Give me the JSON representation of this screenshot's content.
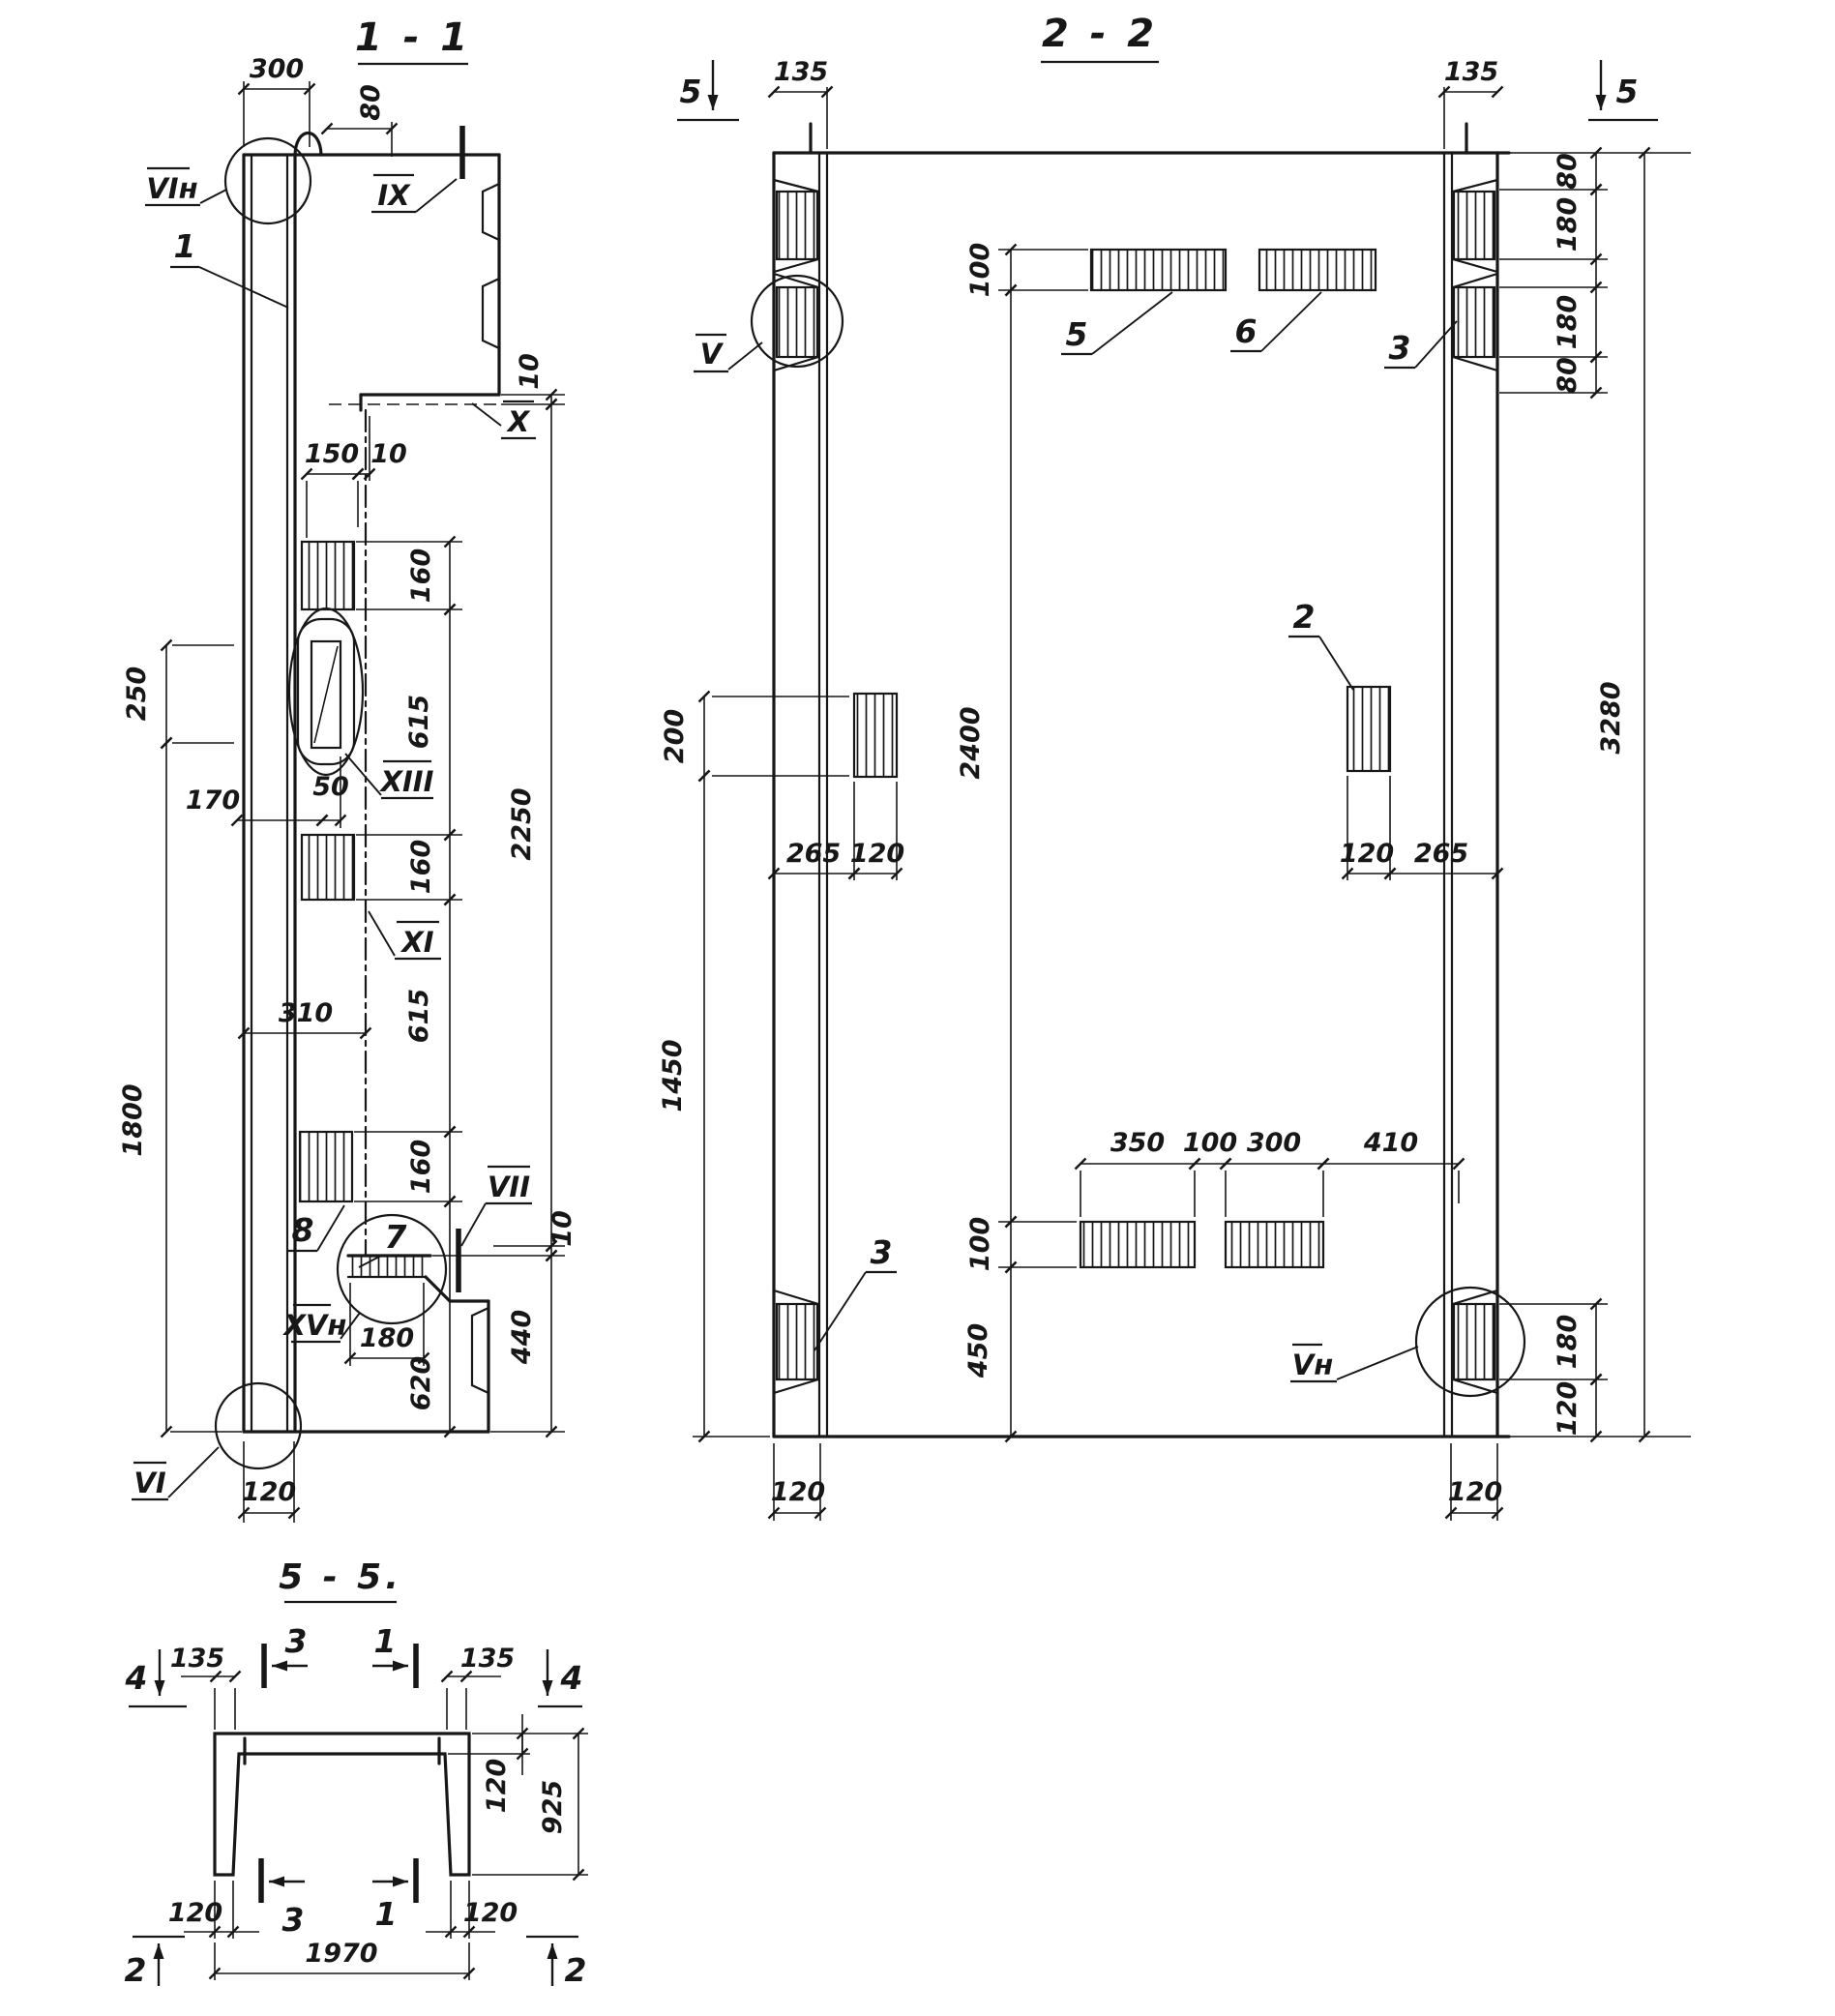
{
  "drawing": {
    "s1": {
      "title": "1 - 1",
      "dims": {
        "d300": "300",
        "d80": "80",
        "d150": "150",
        "d10a": "10",
        "d10b": "10",
        "d10c": "10",
        "d160a": "160",
        "d615a": "615",
        "d160b": "160",
        "d615b": "615",
        "d160c": "160",
        "d250": "250",
        "d170": "170",
        "d50": "50",
        "d310": "310",
        "d1800": "1800",
        "d2250": "2250",
        "d440": "440",
        "d620": "620",
        "d180": "180",
        "d120": "120"
      },
      "marks": {
        "vin": "VIн",
        "ix": "IX",
        "x": "X",
        "xiii": "XIII",
        "xi": "XI",
        "vii": "VII",
        "xvn": "XVн",
        "vi": "VI"
      },
      "callouts": {
        "c1": "1",
        "c7": "7",
        "c8": "8"
      }
    },
    "s2": {
      "title": "2 - 2",
      "cutmark5l": "5",
      "cutmark5r": "5",
      "dims": {
        "d135l": "135",
        "d135r": "135",
        "d80a": "80",
        "d180a": "180",
        "d180b": "180",
        "d80b": "80",
        "d3280": "3280",
        "d100t": "100",
        "d2400": "2400",
        "d100b": "100",
        "d450": "450",
        "d200": "200",
        "d1450": "1450",
        "d265l": "265",
        "d120l": "120",
        "d120r": "120",
        "d265r": "265",
        "d350": "350",
        "d100m": "100",
        "d300": "300",
        "d410": "410",
        "d180br": "180",
        "d120br": "120",
        "d120bl": "120",
        "d120brr": "120"
      },
      "marks": {
        "v": "V",
        "vn": "Vн"
      },
      "callouts": {
        "c2": "2",
        "c3t": "3",
        "c3b": "3",
        "c5": "5",
        "c6": "6"
      }
    },
    "s5": {
      "title": "5 - 5.",
      "dims": {
        "d135l": "135",
        "d135r": "135",
        "d120fl": "120",
        "d925": "925",
        "d120bl": "120",
        "d120br": "120",
        "d1970": "1970"
      },
      "markers": {
        "m4l": "4",
        "m4r": "4",
        "m3t": "3",
        "m1t": "1",
        "m3b": "3",
        "m1b": "1",
        "m2l": "2",
        "m2r": "2"
      }
    }
  }
}
